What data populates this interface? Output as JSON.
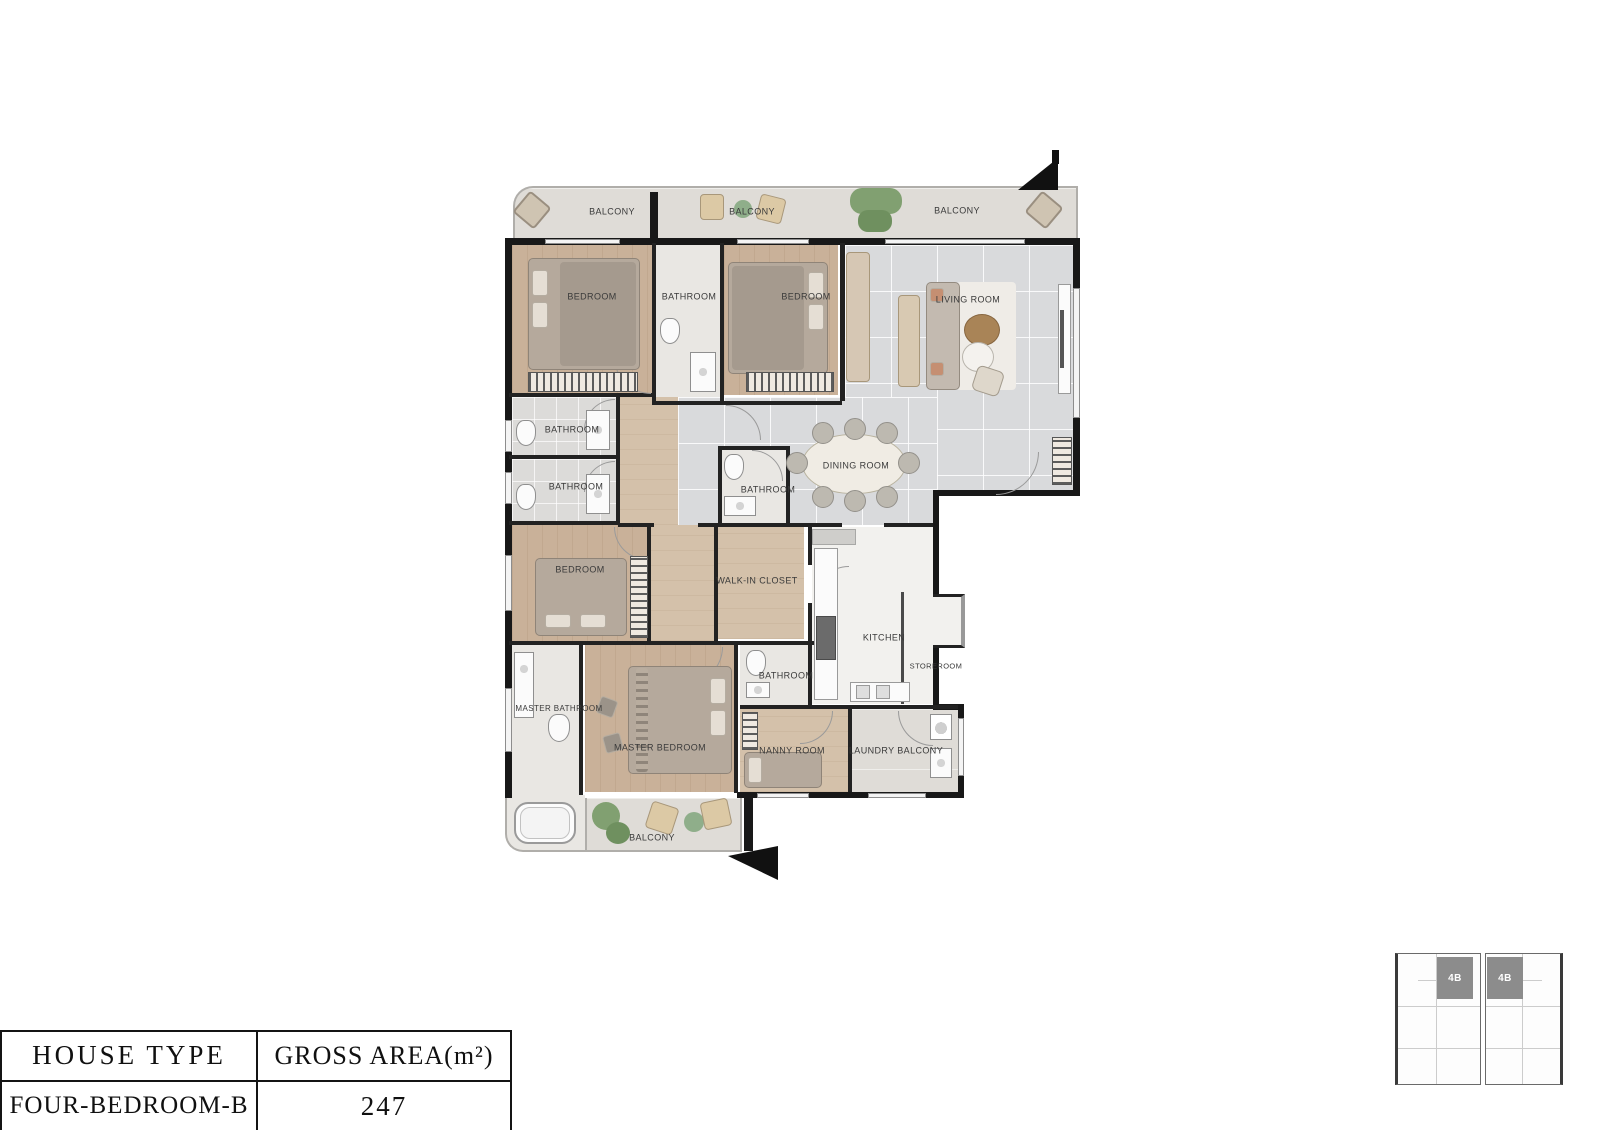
{
  "colors": {
    "wall": "#181818",
    "wood_floor": "#c9b199",
    "tile_floor": "#d9dadc",
    "balcony_floor": "#dfdcd7",
    "bath_floor": "#e9e7e3",
    "kitchen_floor": "#f2f1ee",
    "keyplan_unit_fill": "#8c8c8c"
  },
  "plan": {
    "rooms": {
      "balcony_top_left": "BALCONY",
      "balcony_top_mid": "BALCONY",
      "balcony_top_right": "BALCONY",
      "bedroom_top_left": "BEDROOM",
      "bathroom_top": "BATHROOM",
      "bedroom_top_mid": "BEDROOM",
      "living_room": "LIVING ROOM",
      "bathroom_mid_1": "BATHROOM",
      "bathroom_mid_2": "BATHROOM",
      "bathroom_center": "BATHROOM",
      "dining_room": "DINING ROOM",
      "bedroom_left": "BEDROOM",
      "walk_in_closet": "WALK-IN CLOSET",
      "kitchen": "KITCHEN",
      "storeroom": "STOREROOM",
      "master_bathroom": "MASTER BATHROOM",
      "master_bedroom": "MASTER BEDROOM",
      "bathroom_lower": "BATHROOM",
      "nanny_room": "NANNY ROOM",
      "laundry_balcony": "LAUNDRY BALCONY",
      "balcony_bottom": "BALCONY"
    }
  },
  "info_table": {
    "headers": [
      "HOUSE TYPE",
      "GROSS AREA(m²)"
    ],
    "row": [
      "FOUR-BEDROOM-B",
      "247"
    ]
  },
  "keyplan": {
    "units": [
      "4B",
      "4B"
    ]
  }
}
